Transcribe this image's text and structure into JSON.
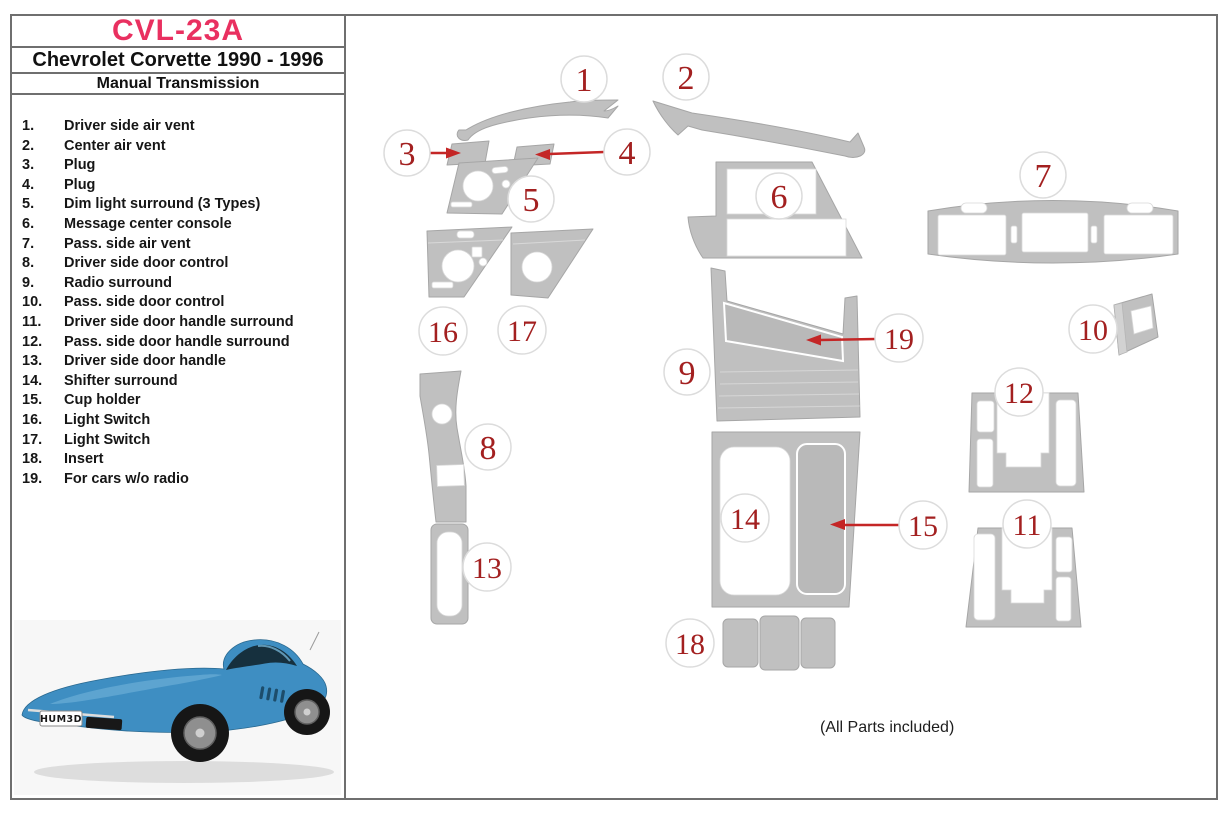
{
  "header": {
    "product_code": "CVL-23A",
    "vehicle": "Chevrolet Corvette 1990 - 1996",
    "transmission": "Manual Transmission"
  },
  "parts_list": [
    {
      "num": "1.",
      "label": "Driver side air vent"
    },
    {
      "num": "2.",
      "label": "Center air vent"
    },
    {
      "num": "3.",
      "label": "Plug"
    },
    {
      "num": "4.",
      "label": "Plug"
    },
    {
      "num": "5.",
      "label": "Dim light surround (3 Types)"
    },
    {
      "num": "6.",
      "label": "Message center console"
    },
    {
      "num": "7.",
      "label": "Pass. side air vent"
    },
    {
      "num": "8.",
      "label": "Driver side door control"
    },
    {
      "num": "9.",
      "label": "Radio surround"
    },
    {
      "num": "10.",
      "label": "Pass. side door control"
    },
    {
      "num": "11.",
      "label": "Driver side door handle surround"
    },
    {
      "num": "12.",
      "label": "Pass. side door handle surround"
    },
    {
      "num": "13.",
      "label": "Driver side door handle"
    },
    {
      "num": "14.",
      "label": "Shifter surround"
    },
    {
      "num": "15.",
      "label": "Cup holder"
    },
    {
      "num": "16.",
      "label": "Light Switch"
    },
    {
      "num": "17.",
      "label": "Light Switch"
    },
    {
      "num": "18.",
      "label": "Insert"
    },
    {
      "num": "19.",
      "label": "For cars w/o radio"
    }
  ],
  "badges": [
    "1",
    "2",
    "3",
    "4",
    "5",
    "6",
    "7",
    "8",
    "9",
    "10",
    "11",
    "12",
    "13",
    "14",
    "15",
    "16",
    "17",
    "18",
    "19"
  ],
  "footer_note": "(All Parts included)",
  "car": {
    "license_plate": "HUM3D",
    "body_color": "#3e8ec2"
  },
  "colors": {
    "title_pink": "#e93060",
    "callout_red": "#a32020",
    "arrow_red": "#c42626",
    "part_gray": "#c0c0c0",
    "border_gray": "#6f6f6f"
  }
}
